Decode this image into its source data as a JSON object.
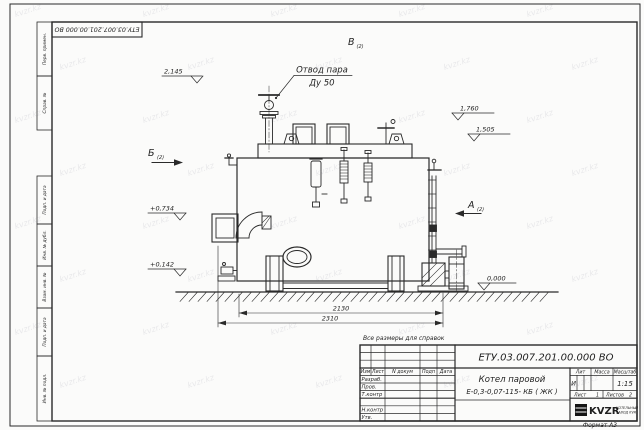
{
  "sheet": {
    "doc_number": "ЕТУ.03.007.201.00.000  ВО",
    "note": "Все размеры для справок",
    "format_label": "Формат А3",
    "watermark": "kvzr.kz"
  },
  "margin_labels": [
    "Перв. примен.",
    "Справ. №",
    "Подп. и дата",
    "Инв. № дубл.",
    "Взам. инв. №",
    "Подп. и дата",
    "Инв. № подл."
  ],
  "drawing": {
    "labels": {
      "steam_outlet_line1": "Отвод пара",
      "steam_outlet_line2": "Ду 50",
      "view_a": "А",
      "view_b": "Б",
      "view_v": "В",
      "view_sheet_ref": "(2)"
    },
    "elevations": {
      "e2145": "2,145",
      "e1760": "1,760",
      "e1505": "1,505",
      "e0734": "+0,734",
      "e0142": "+0,142",
      "e0000": "0,000"
    },
    "dimensions": {
      "inner": "2130",
      "outer": "2310"
    }
  },
  "titleblock": {
    "doc_number": "ЕТУ.03.007.201.00.000  ВО",
    "product_name_line1": "Котел паровой",
    "product_name_line2": "Е-0,3-0,07-115- КБ ( ЖК )",
    "col_headers": {
      "izm": "Изм",
      "list": "Лист",
      "ndoc": "N докум",
      "podp": "Подп",
      "data": "Дата"
    },
    "rows": [
      "Разраб.",
      "Пров.",
      "Т.контр",
      "",
      "Н.контр",
      "Утв."
    ],
    "lit_header": "Лит",
    "mass_header": "Масса",
    "scale_header": "Масштаб",
    "lit": "И",
    "scale": "1:15",
    "sheet_label": "Лист",
    "sheet_no": "1",
    "sheets_label": "Листов",
    "sheets_no": "2",
    "logo_text": "KVZR",
    "logo_sub1": "КОТЕЛЬНЫЙ",
    "logo_sub2": "ЗАВОД KVR"
  }
}
